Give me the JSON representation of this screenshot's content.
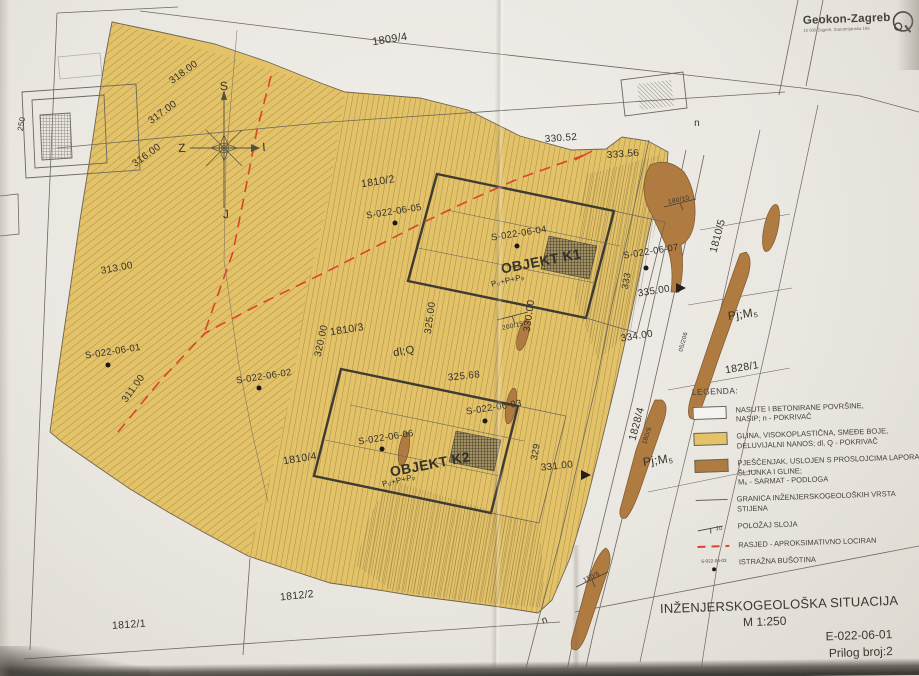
{
  "logo": {
    "name": "Geokon-Zagreb",
    "address": "10 000 Zagreb, Starotrnjanska 19a"
  },
  "title_block": {
    "title": "INŽENJERSKOGEOLOŠKA SITUACIJA",
    "scale": "M 1:250",
    "doc_number": "E-022-06-01",
    "attachment": "Prilog broj:2"
  },
  "legend": {
    "heading": "LEGENDA:",
    "items": [
      {
        "name": "nasip",
        "lines": [
          "NASUTE I BETONIRANE POVRŠINE,",
          "NASIP; n - POKRIVAČ"
        ]
      },
      {
        "name": "glina",
        "lines": [
          "GLINA, VISOKOPLASTIČNA, SMEĐE BOJE,",
          "DELUVIJALNI NANOS; dl, Q - POKRIVAČ"
        ]
      },
      {
        "name": "pjescenjak",
        "lines": [
          "PJEŠČENJAK, USLOJEN S PROSLOJCIMA LAPORA,",
          "ŠLJUNKA I GLINE;",
          "M₅ - SARMAT - PODLOGA"
        ]
      },
      {
        "name": "granica",
        "lines": [
          "GRANICA INŽENJERSKOGEOLOŠKIH VRSTA STIJENA"
        ]
      },
      {
        "name": "polozaj-sloja",
        "lines": [
          "POLOŽAJ SLOJA"
        ],
        "symbol": "10"
      },
      {
        "name": "rasjed",
        "lines": [
          "RASJED - APROKSIMATIVNO LOCIRAN"
        ]
      },
      {
        "name": "busotina",
        "lines": [
          "ISTRAŽNA BUŠOTINA"
        ],
        "symbol": "S-022-06-03"
      }
    ]
  },
  "colors": {
    "clay": "#e3c268",
    "sandstone": "#b07b40",
    "fault": "#d9452b",
    "paper": "#efede8"
  },
  "map": {
    "labels": [
      {
        "t": "1809/4",
        "x": 390,
        "y": 40,
        "r": -9,
        "s": 11,
        "n": "parcel-1809-4"
      },
      {
        "t": "318.00",
        "x": 184,
        "y": 73,
        "r": -36,
        "s": 10,
        "n": "elevation-318"
      },
      {
        "t": "317.00",
        "x": 163,
        "y": 113,
        "r": -36,
        "s": 10,
        "n": "elevation-317"
      },
      {
        "t": "316.00",
        "x": 147,
        "y": 156,
        "r": -36,
        "s": 10,
        "n": "elevation-316"
      },
      {
        "t": "330.52",
        "x": 561,
        "y": 139,
        "r": -4,
        "s": 10,
        "n": "elevation-330-52"
      },
      {
        "t": "333.56",
        "x": 623,
        "y": 155,
        "r": -4,
        "s": 10,
        "n": "elevation-333-56"
      },
      {
        "t": "313.00",
        "x": 117,
        "y": 269,
        "r": -11,
        "s": 10,
        "n": "elevation-313"
      },
      {
        "t": "311.00",
        "x": 134,
        "y": 389,
        "r": -54,
        "s": 10,
        "n": "elevation-311"
      },
      {
        "t": "320.00",
        "x": 322,
        "y": 341,
        "r": -78,
        "s": 10,
        "n": "elevation-320"
      },
      {
        "t": "325.00",
        "x": 431,
        "y": 318,
        "r": -82,
        "s": 10,
        "n": "elevation-325"
      },
      {
        "t": "330.00",
        "x": 530,
        "y": 316,
        "r": -82,
        "s": 10,
        "n": "elevation-330"
      },
      {
        "t": "325.68",
        "x": 464,
        "y": 377,
        "r": -6,
        "s": 10,
        "n": "elevation-325-68"
      },
      {
        "t": "334.00",
        "x": 637,
        "y": 337,
        "r": -9,
        "s": 10,
        "n": "elevation-334"
      },
      {
        "t": "335.00",
        "x": 654,
        "y": 292,
        "r": -9,
        "s": 10,
        "n": "elevation-335"
      },
      {
        "t": "331.00",
        "x": 557,
        "y": 467,
        "r": -6,
        "s": 10,
        "n": "elevation-331"
      },
      {
        "t": "329",
        "x": 536,
        "y": 452,
        "r": -80,
        "s": 9.5,
        "n": "elevation-329"
      },
      {
        "t": "333",
        "x": 627,
        "y": 281,
        "r": -80,
        "s": 9.5,
        "n": "elevation-333"
      },
      {
        "t": "1810/2",
        "x": 378,
        "y": 182,
        "r": -9,
        "s": 10.5,
        "n": "parcel-1810-2"
      },
      {
        "t": "1810/3",
        "x": 347,
        "y": 330,
        "r": -9,
        "s": 10.5,
        "n": "parcel-1810-3"
      },
      {
        "t": "1810/4",
        "x": 300,
        "y": 459,
        "r": -9,
        "s": 10.5,
        "n": "parcel-1810-4"
      },
      {
        "t": "1810/5",
        "x": 718,
        "y": 236,
        "r": -75,
        "s": 10.5,
        "n": "parcel-1810-5"
      },
      {
        "t": "1828/1",
        "x": 742,
        "y": 368,
        "r": -9,
        "s": 10.5,
        "n": "parcel-1828-1"
      },
      {
        "t": "1828/4",
        "x": 637,
        "y": 424,
        "r": -75,
        "s": 10.5,
        "n": "parcel-1828-4"
      },
      {
        "t": "1812/2",
        "x": 297,
        "y": 596,
        "r": -6,
        "s": 10.5,
        "n": "parcel-1812-2"
      },
      {
        "t": "1812/1",
        "x": 129,
        "y": 625,
        "r": -4,
        "s": 10.5,
        "n": "parcel-1812-1"
      },
      {
        "t": "250",
        "x": 22,
        "y": 124,
        "r": -80,
        "s": 8,
        "n": "label-250"
      },
      {
        "t": "n",
        "x": 697,
        "y": 124,
        "r": 0,
        "s": 10,
        "n": "cover-label-n-top"
      },
      {
        "t": "n",
        "x": 545,
        "y": 621,
        "r": -20,
        "s": 10,
        "n": "cover-label-n-bottom"
      },
      {
        "t": "dl;Q",
        "x": 404,
        "y": 352,
        "r": -10,
        "s": 11,
        "n": "cover-label-dlq"
      },
      {
        "t": "Pj;M₅",
        "x": 743,
        "y": 314,
        "r": -8,
        "s": 12,
        "n": "unit-label-pjm5-upper"
      },
      {
        "t": "Pj;M₅",
        "x": 658,
        "y": 460,
        "r": -8,
        "s": 12,
        "n": "unit-label-pjm5-lower"
      },
      {
        "t": "180/10",
        "x": 679,
        "y": 201,
        "r": -12,
        "s": 6.5,
        "n": "dip-180-10"
      },
      {
        "t": "180/5",
        "x": 648,
        "y": 436,
        "r": -72,
        "s": 6.5,
        "n": "dip-180-5"
      },
      {
        "t": "150/5",
        "x": 592,
        "y": 578,
        "r": -25,
        "s": 6.5,
        "n": "dip-150-5"
      },
      {
        "t": "200/15",
        "x": 513,
        "y": 327,
        "r": -12,
        "s": 6.5,
        "n": "dip-200-15"
      },
      {
        "t": "05/206",
        "x": 684,
        "y": 342,
        "r": -75,
        "s": 6,
        "n": "road-parcel-number"
      },
      {
        "t": "OBJEKT K1",
        "x": 541,
        "y": 261,
        "r": -11,
        "s": 14,
        "b": 1,
        "n": "objekt-k1-label"
      },
      {
        "t": "OBJEKT K2",
        "x": 430,
        "y": 464,
        "r": -11,
        "s": 14,
        "b": 1,
        "n": "objekt-k2-label"
      },
      {
        "t": "P₀+P+Pₚ",
        "x": 508,
        "y": 281,
        "r": -13,
        "s": 8,
        "n": "objekt-k1-storeys"
      },
      {
        "t": "P₀+P+Pₚ",
        "x": 399,
        "y": 481,
        "r": -13,
        "s": 8,
        "n": "objekt-k2-storeys"
      },
      {
        "t": "S",
        "x": 224,
        "y": 86,
        "r": -4,
        "s": 12,
        "n": "compass-letter-north"
      },
      {
        "t": "Z",
        "x": 182,
        "y": 148,
        "r": -4,
        "s": 12,
        "n": "compass-letter-west"
      },
      {
        "t": "I",
        "x": 264,
        "y": 147,
        "r": -4,
        "s": 12,
        "n": "compass-letter-east"
      },
      {
        "t": "J",
        "x": 226,
        "y": 214,
        "r": -4,
        "s": 12,
        "n": "compass-letter-south"
      }
    ],
    "boreholes": [
      {
        "id": "S-022-06-01",
        "x": 113,
        "y": 352,
        "r": -9,
        "dx": 108,
        "dy": 365
      },
      {
        "id": "S-022-06-02",
        "x": 264,
        "y": 377,
        "r": -9,
        "dx": 259,
        "dy": 388
      },
      {
        "id": "S-022-06-03",
        "x": 494,
        "y": 408,
        "r": -9,
        "dx": 485,
        "dy": 421
      },
      {
        "id": "S-022-06-04",
        "x": 519,
        "y": 234,
        "r": -9,
        "dx": 517,
        "dy": 246
      },
      {
        "id": "S-022-06-05",
        "x": 394,
        "y": 212,
        "r": -9,
        "dx": 395,
        "dy": 223
      },
      {
        "id": "S-022-06-06",
        "x": 386,
        "y": 438,
        "r": -9,
        "dx": 382,
        "dy": 449
      },
      {
        "id": "S-022-06-07",
        "x": 651,
        "y": 252,
        "r": -9,
        "dx": 646,
        "dy": 268
      }
    ]
  }
}
